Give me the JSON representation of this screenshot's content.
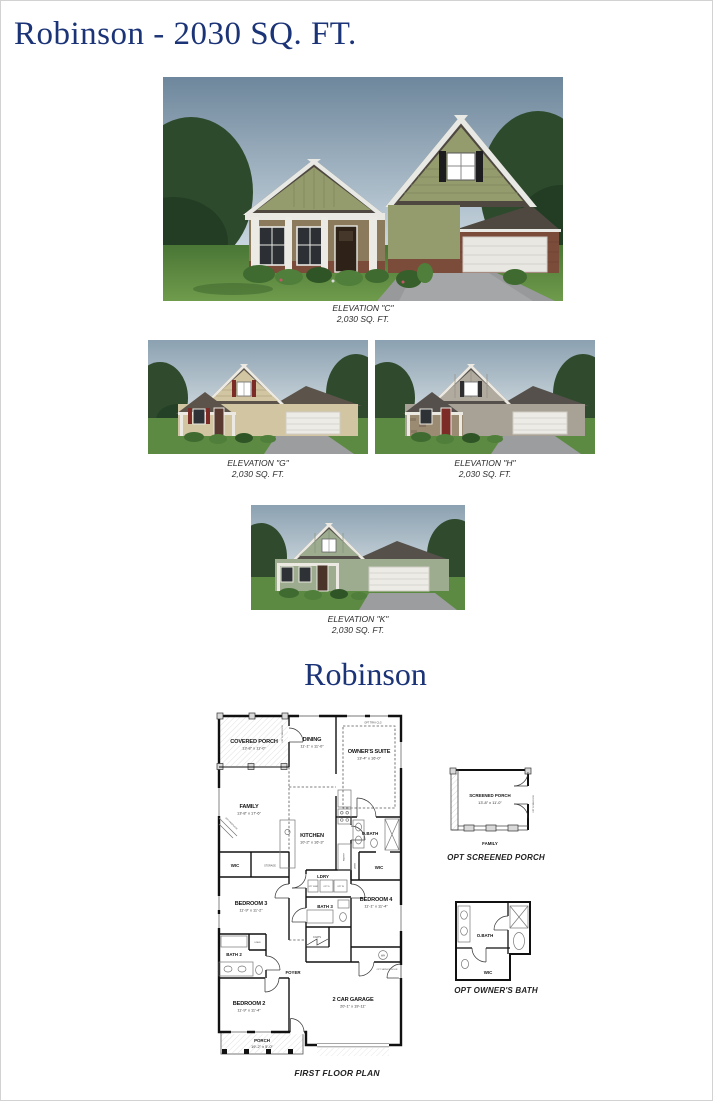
{
  "page": {
    "title": "Robinson - 2030 SQ. FT.",
    "plan_title": "Robinson",
    "accent_color": "#1b3377"
  },
  "elevations": [
    {
      "id": "c",
      "label": "ELEVATION \"C\"",
      "sqft": "2,030 SQ. FT."
    },
    {
      "id": "g",
      "label": "ELEVATION \"G\"",
      "sqft": "2,030 SQ. FT."
    },
    {
      "id": "h",
      "label": "ELEVATION \"H\"",
      "sqft": "2,030 SQ. FT."
    },
    {
      "id": "k",
      "label": "ELEVATION \"K\"",
      "sqft": "2,030 SQ. FT."
    }
  ],
  "floor_plan": {
    "caption": "FIRST FLOOR PLAN",
    "rooms": {
      "covered_porch": {
        "name": "COVERED PORCH",
        "dims": "13'-8\" x 11'-0\""
      },
      "dining": {
        "name": "DINING",
        "dims": "11'-1\" x 11'-0\""
      },
      "owners_suite": {
        "name": "OWNER'S SUITE",
        "dims": "13'-4\" x 16'-0\""
      },
      "family": {
        "name": "FAMILY",
        "dims": "13'-8\" x 17'-6\""
      },
      "kitchen": {
        "name": "KITCHEN",
        "dims": "10'-2\" x 16'-3\""
      },
      "obath": {
        "name": "O.BATH"
      },
      "wic_owner": {
        "name": "WIC"
      },
      "wic_small": {
        "name": "WIC"
      },
      "storage": {
        "name": "STORAGE"
      },
      "pantry": {
        "name": "PANTRY"
      },
      "bedroom3": {
        "name": "BEDROOM 3",
        "dims": "11'-9\" x 11'-2\""
      },
      "ldry": {
        "name": "LDRY"
      },
      "bath3": {
        "name": "BATH 3"
      },
      "bedroom4": {
        "name": "BEDROOM 4",
        "dims": "11'-1\" x 11'-4\""
      },
      "bath2": {
        "name": "BATH 2"
      },
      "linen": {
        "name": "LINEN"
      },
      "coats": {
        "name": "COATS"
      },
      "foyer": {
        "name": "FOYER"
      },
      "bedroom2": {
        "name": "BEDROOM 2",
        "dims": "11'-9\" x 11'-4\""
      },
      "porch": {
        "name": "PORCH",
        "dims": "19'-2\" x 5'-0\""
      },
      "garage": {
        "name": "2 CAR GARAGE",
        "dims": "20'-1\" x 19'-11\""
      }
    },
    "annotations": {
      "opt_tray_clg": "OPT TRAY CLG",
      "opt_scrn_door": "OPT SCRN DOOR",
      "opt_fireplace": "OPT FIREPLACE",
      "opt_service_door": "OPT SERVICE DOOR",
      "opt_sink": "OPT SINK",
      "opt_d": "OPT D",
      "opt_w": "OPT W",
      "wh": "WH"
    }
  },
  "options": {
    "screened_porch": {
      "caption": "OPT SCREENED PORCH",
      "room": "SCREENED PORCH",
      "dims": "13'-8\" x 11'-0\"",
      "room_below": "FAMILY",
      "door_note": "OPT SCRN DOOR"
    },
    "owners_bath": {
      "caption": "OPT OWNER'S BATH",
      "room": "O.BATH",
      "wic": "WIC"
    }
  }
}
